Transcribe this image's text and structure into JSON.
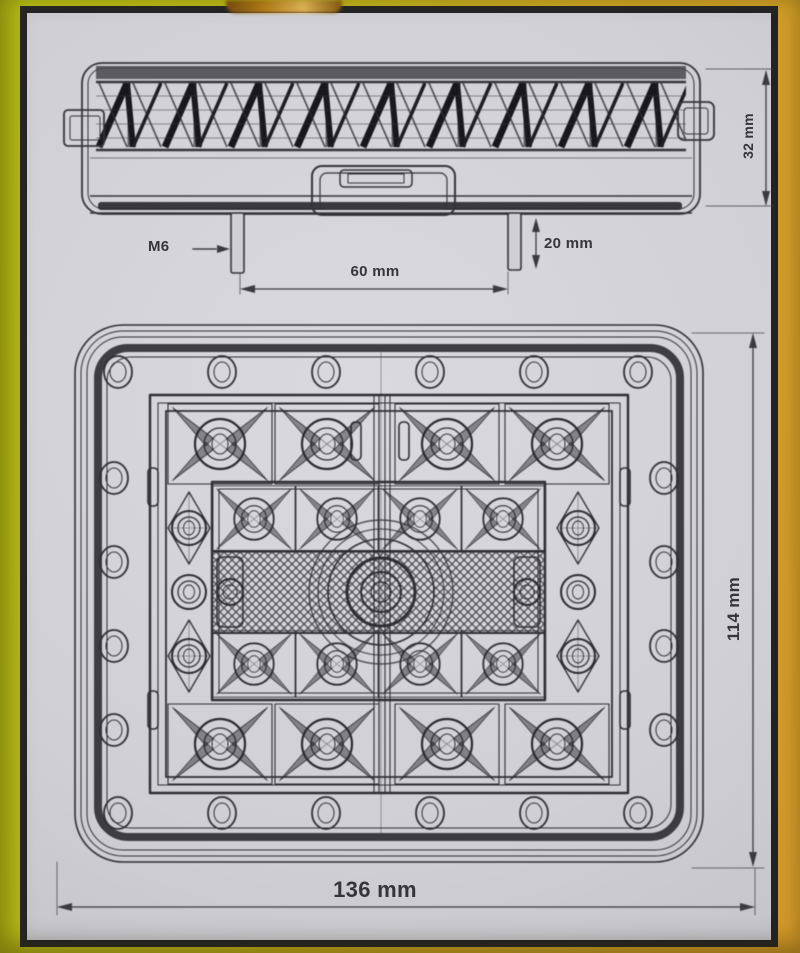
{
  "labels": {
    "side_height": "32 mm",
    "thread": "M6",
    "stud_length": "20 mm",
    "stud_spacing": "60 mm",
    "front_width": "136 mm",
    "front_height": "114 mm"
  },
  "colors": {
    "background_left": "#b8be16",
    "background_right": "#d59a2b",
    "paper": "#cfcfd4",
    "frame": "#232327",
    "ink": "#34343a"
  }
}
